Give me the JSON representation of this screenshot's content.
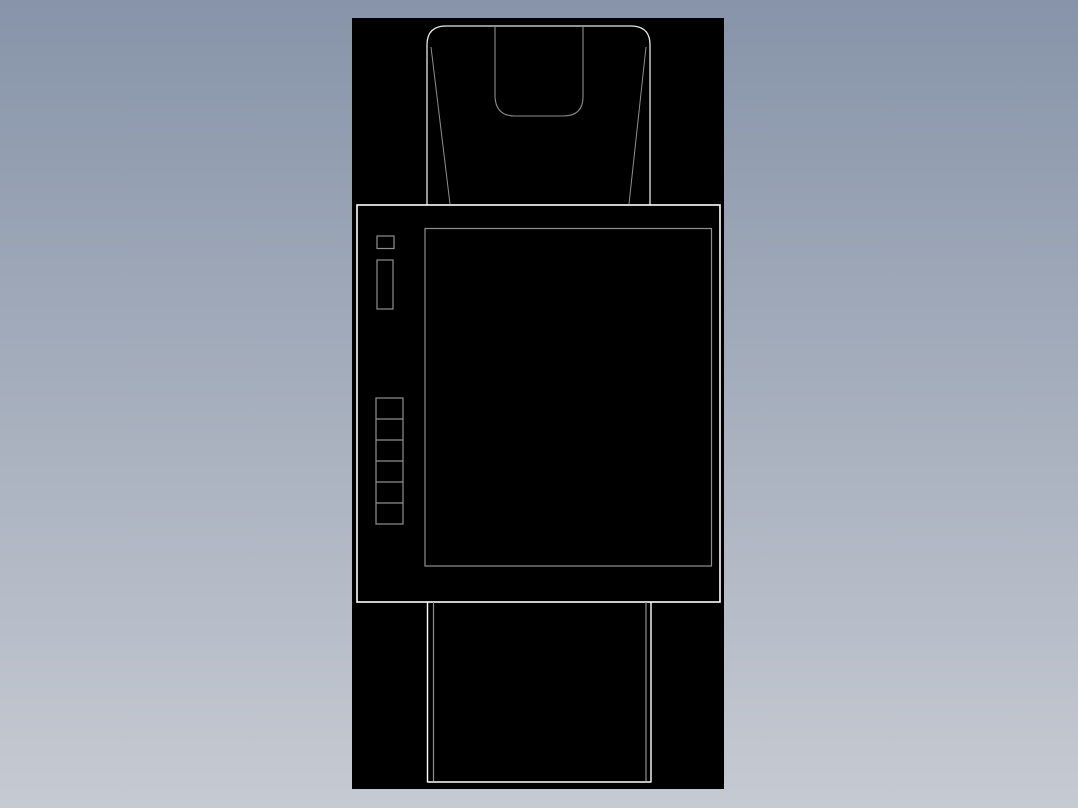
{
  "meta": {
    "title": "CAD drawing preview",
    "description": "Wireframe technical drawing of a device (hooded top, control panel with screen and button column, base) rendered as light outlines on a black canvas over a gradient desktop background"
  },
  "colors": {
    "background_top": "#8794a9",
    "background_bottom": "#c6cad2",
    "canvas_bg": "#000000",
    "line_primary": "#ffffff",
    "line_light": "#e8e8e8",
    "line_secondary": "#8f8f8f"
  },
  "canvas": {
    "x": 352,
    "y": 18,
    "width": 372,
    "height": 771
  },
  "drawing": {
    "shapes": [
      {
        "name": "hood-outline",
        "type": "path",
        "d": "M 75 187 L 75 27 Q 75 8 94 8 L 279 8 Q 298 8 298 27 L 298 187",
        "stroke": "line_light",
        "width": 1.3
      },
      {
        "name": "hood-taper-line-left",
        "type": "line",
        "x1": 79,
        "y1": 29,
        "x2": 98,
        "y2": 186,
        "stroke": "line_secondary",
        "width": 1
      },
      {
        "name": "hood-taper-line-right",
        "type": "line",
        "x1": 294,
        "y1": 29,
        "x2": 277,
        "y2": 186,
        "stroke": "line_secondary",
        "width": 1
      },
      {
        "name": "hood-notch",
        "type": "path",
        "d": "M 143 8 L 143 79 Q 144 98 163 98 L 211 98 Q 231 98 231 79 L 231 8",
        "stroke": "line_secondary",
        "width": 1.1
      },
      {
        "name": "panel-outline",
        "type": "rect",
        "x": 5,
        "y": 187,
        "w": 363,
        "h": 397,
        "stroke": "line_primary",
        "width": 1.6
      },
      {
        "name": "screen-outline",
        "type": "rect",
        "x": 73,
        "y": 210.5,
        "w": 286.5,
        "h": 337.5,
        "stroke": "line_secondary",
        "width": 1.2
      },
      {
        "name": "indicator-small",
        "type": "rect",
        "x": 25,
        "y": 218,
        "w": 17,
        "h": 12.5,
        "stroke": "line_secondary",
        "width": 1.2
      },
      {
        "name": "indicator-tall",
        "type": "rect",
        "x": 25,
        "y": 242,
        "w": 16,
        "h": 49,
        "stroke": "line_secondary",
        "width": 1.2
      },
      {
        "name": "button-column",
        "type": "rect",
        "x": 24,
        "y": 380,
        "w": 27,
        "h": 126,
        "stroke": "line_secondary",
        "width": 1.2
      },
      {
        "name": "button-divider-1",
        "type": "line",
        "x1": 24,
        "y1": 401,
        "x2": 51,
        "y2": 401,
        "stroke": "line_secondary",
        "width": 1.2
      },
      {
        "name": "button-divider-2",
        "type": "line",
        "x1": 24,
        "y1": 422,
        "x2": 51,
        "y2": 422,
        "stroke": "line_secondary",
        "width": 1.2
      },
      {
        "name": "button-divider-3",
        "type": "line",
        "x1": 24,
        "y1": 443,
        "x2": 51,
        "y2": 443,
        "stroke": "line_secondary",
        "width": 1.2
      },
      {
        "name": "button-divider-4",
        "type": "line",
        "x1": 24,
        "y1": 464,
        "x2": 51,
        "y2": 464,
        "stroke": "line_secondary",
        "width": 1.2
      },
      {
        "name": "button-divider-5",
        "type": "line",
        "x1": 24,
        "y1": 485,
        "x2": 51,
        "y2": 485,
        "stroke": "line_secondary",
        "width": 1.2
      },
      {
        "name": "base-outer-left",
        "type": "line",
        "x1": 75.5,
        "y1": 584,
        "x2": 75.5,
        "y2": 764.5,
        "stroke": "line_primary",
        "width": 1.4
      },
      {
        "name": "base-outer-right",
        "type": "line",
        "x1": 299,
        "y1": 584,
        "x2": 299,
        "y2": 764.5,
        "stroke": "line_primary",
        "width": 1.4
      },
      {
        "name": "base-bottom-edge",
        "type": "line",
        "x1": 75.5,
        "y1": 764,
        "x2": 299,
        "y2": 764,
        "stroke": "line_primary",
        "width": 1.5
      },
      {
        "name": "base-inner-left",
        "type": "line",
        "x1": 81.5,
        "y1": 584,
        "x2": 81.5,
        "y2": 763,
        "stroke": "line_secondary",
        "width": 1.2
      },
      {
        "name": "base-inner-right",
        "type": "line",
        "x1": 294,
        "y1": 584,
        "x2": 294,
        "y2": 763,
        "stroke": "line_secondary",
        "width": 1.2
      }
    ]
  }
}
